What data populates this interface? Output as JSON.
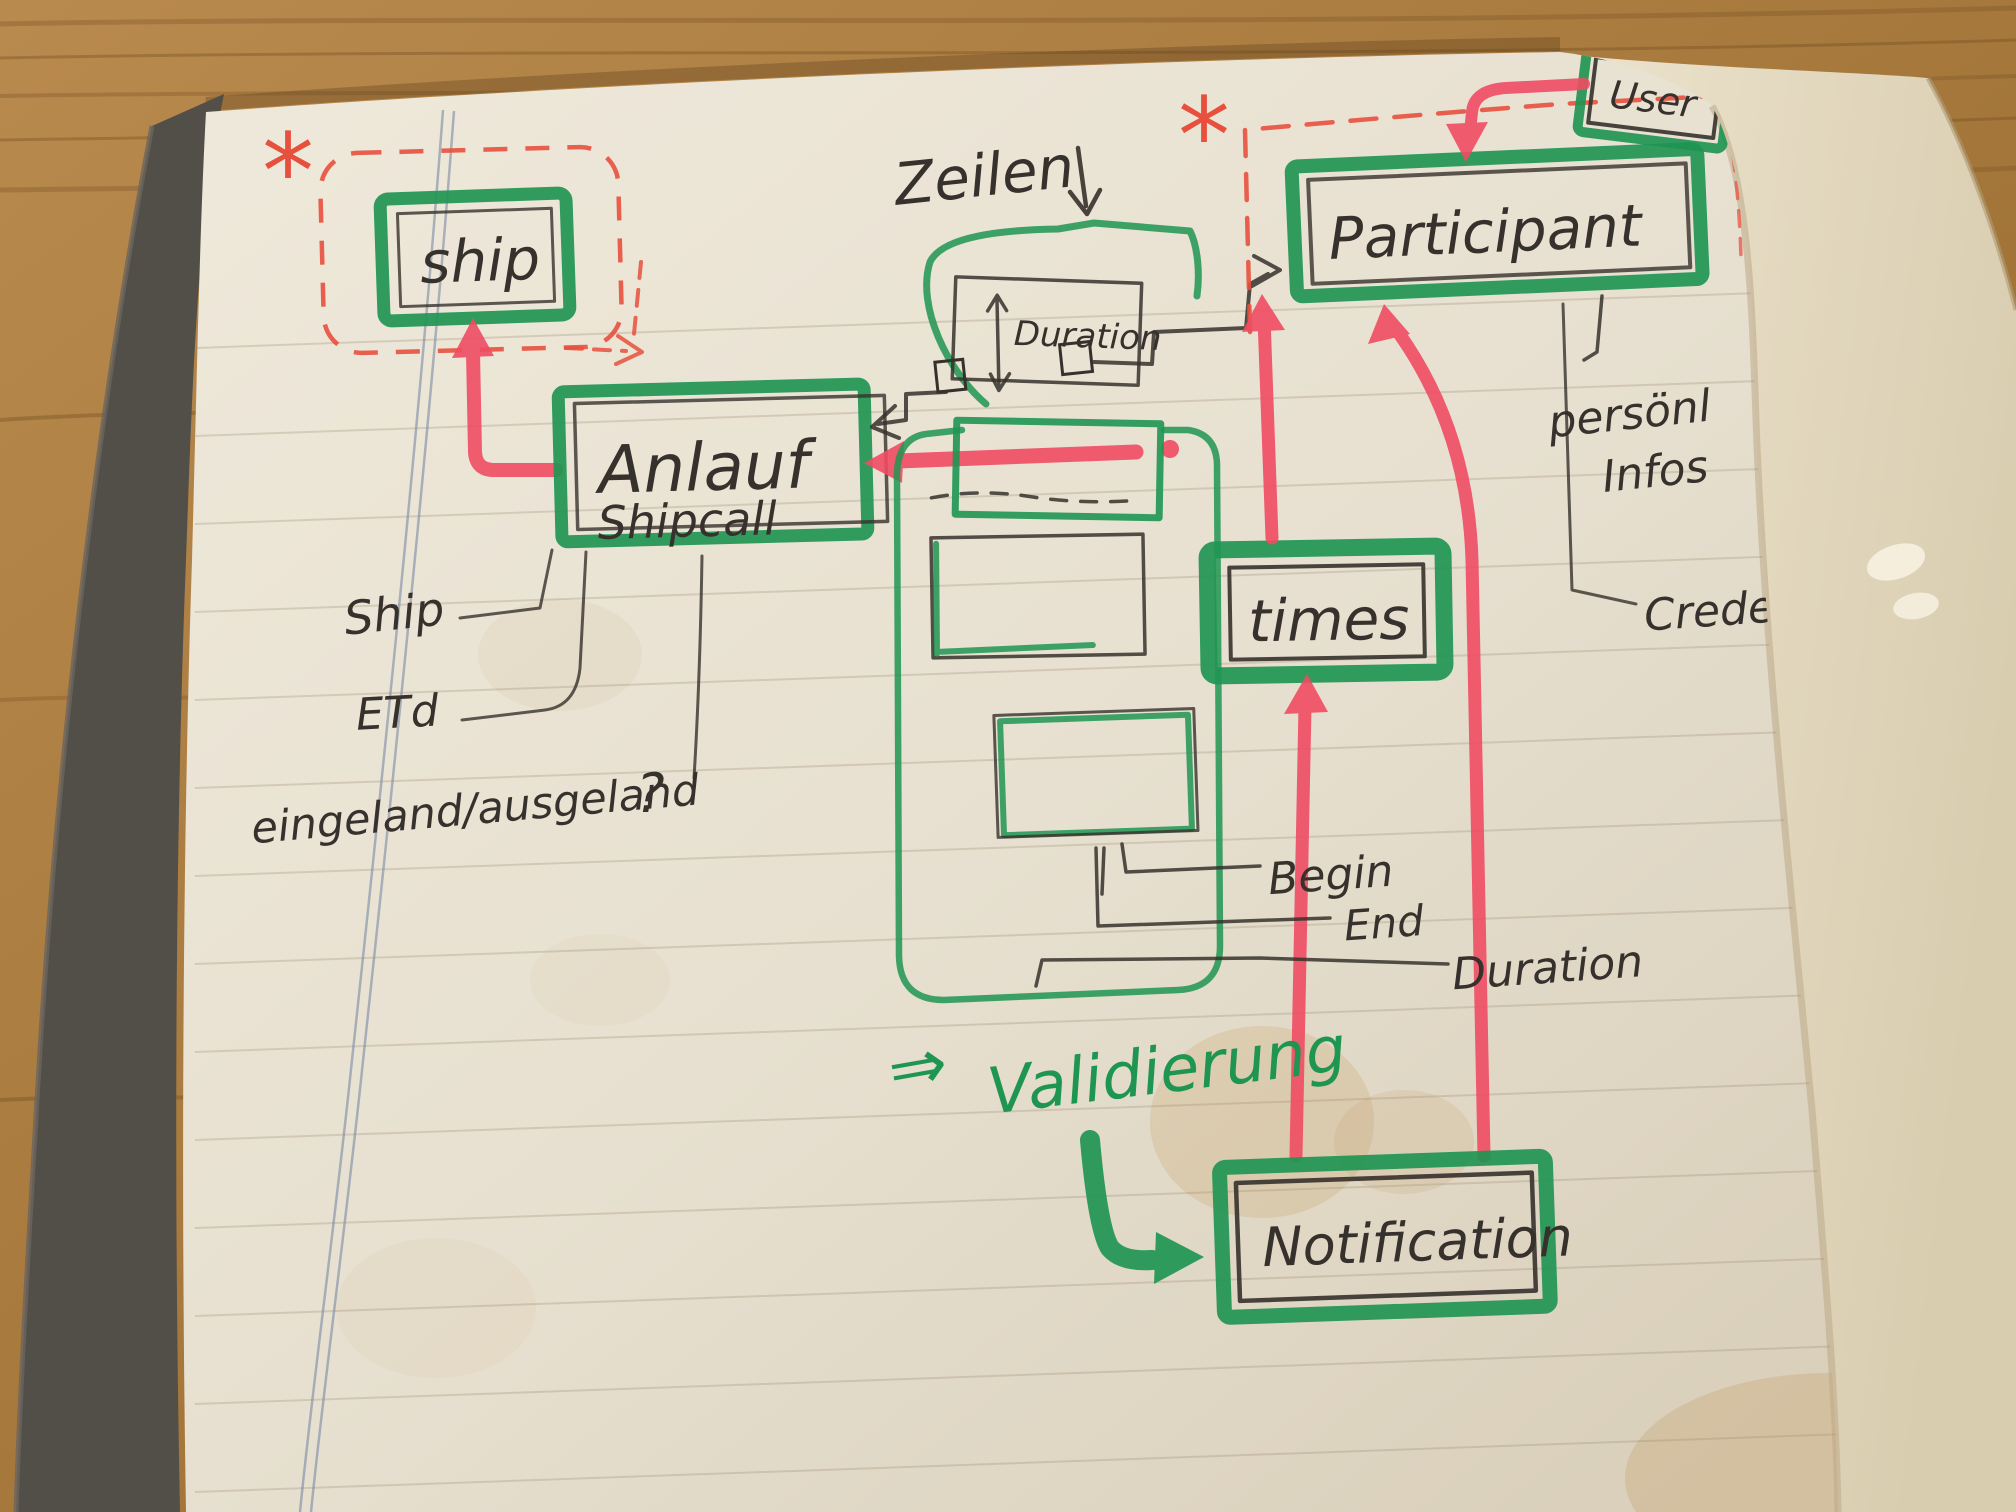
{
  "photo": {
    "entities": {
      "ship": "ship",
      "anlauf": "Anlauf",
      "shipcall": "Shipcall",
      "participant": "Participant",
      "user": "User",
      "duration_box": "Duration",
      "times": "times",
      "notification": "Notification"
    },
    "labels": {
      "zeilen": "Zeilen",
      "asterisk": "*",
      "ship_attr": "Ship",
      "etd": "ETd",
      "in_out": "eingeland/ausgeland",
      "question": "?",
      "begin": "Begin",
      "end": "End",
      "duration": "Duration",
      "personal_1": "persönl",
      "personal_2": "Infos",
      "credentials": "Credentials",
      "implies": "⇒",
      "validierung": "Validierung"
    },
    "colors": {
      "green": "#1f9552",
      "red": "#f04c63",
      "dashred": "#e8503e",
      "ink": "#36312c"
    }
  }
}
